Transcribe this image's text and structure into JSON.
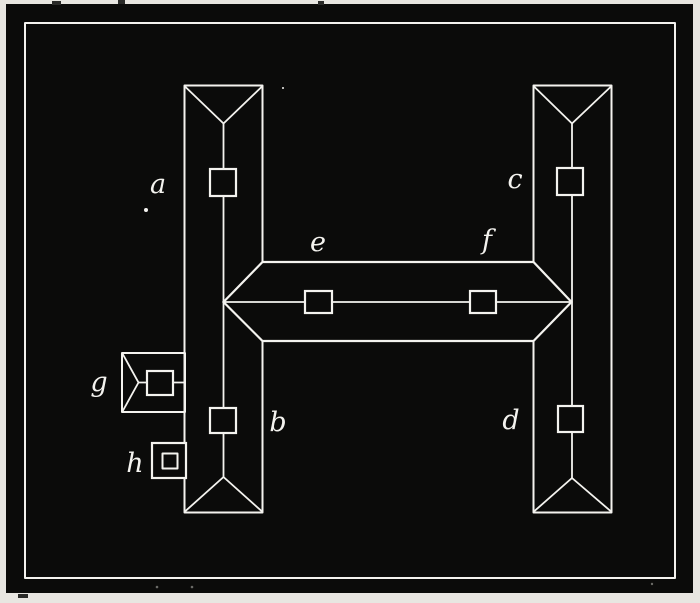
{
  "figure": {
    "kind": "roof-plan-engraving",
    "description": "White-line engraved roof plan of an H-shaped building on a black plate with a white border frame",
    "labels": {
      "a": "a",
      "b": "b",
      "c": "c",
      "d": "d",
      "e": "e",
      "f": "f",
      "g": "g",
      "h": "h"
    }
  },
  "colors": {
    "paper": "#e8e6e1",
    "plate": "#0b0b0a",
    "line": "#f4f3ef",
    "speck": "#6a6a66"
  }
}
